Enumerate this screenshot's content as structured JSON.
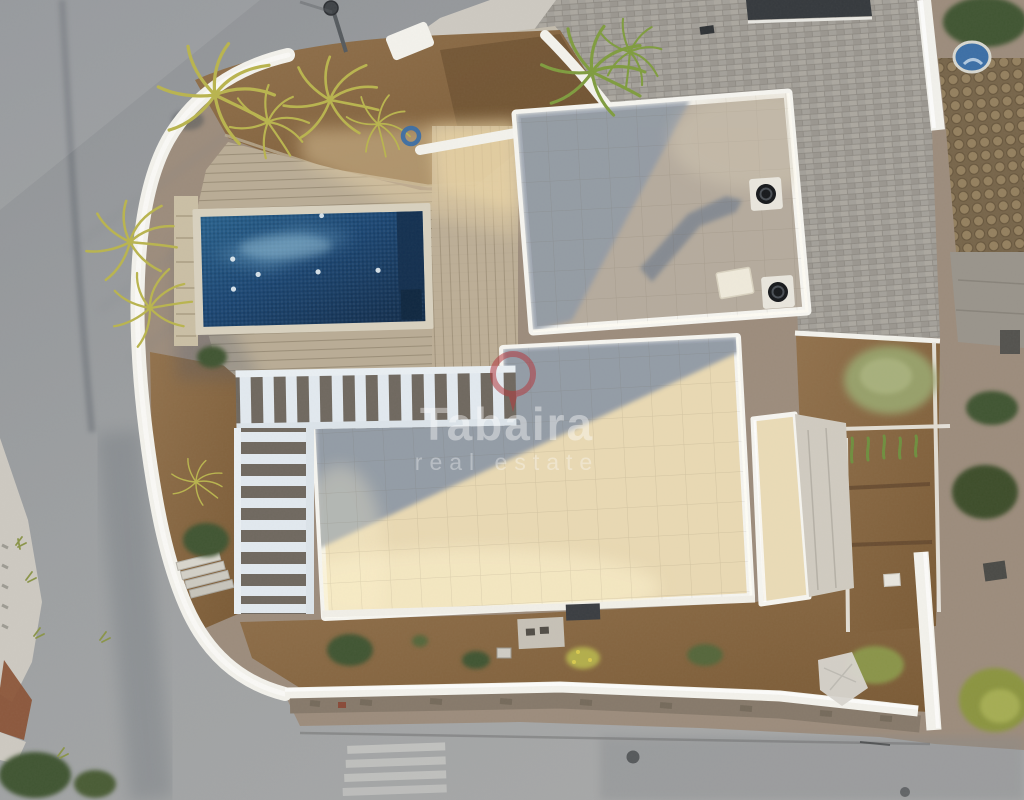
{
  "meta": {
    "image_type": "aerial drone photograph, top-down view",
    "subject": "modern white villa with swimming pool, curved perimeter wall, corner plot beside asphalt road"
  },
  "watermark": {
    "brand": "Tabaira",
    "tagline": "real estate",
    "logo": "map-pin-ring-icon",
    "text_color": "#ffffff",
    "logo_color": "#b23b3f"
  },
  "palette": {
    "road": "#9ea1a3",
    "road_dark": "#7e8286",
    "sidewalk": "#cdc9c1",
    "pavers": "#a3a099",
    "cobble": "#8d7a5e",
    "flagstone": "#99948b",
    "gravel": "#9c8c7c",
    "dirt": "#8a6845",
    "dirt_dark": "#6e5132",
    "deck": "#beb199",
    "deck_sun": "#e8d2a6",
    "stone_strip": "#cabfa5",
    "pool_deep": "#132f4e",
    "pool_main": "#1d4b77",
    "pool_light": "#6fa3c4",
    "coping": "#d8d1bf",
    "wall": "#f3f2ec",
    "stone_wall": "#86796a",
    "roof_field": "#b5ab9d",
    "roof_shadow": "#8f99a6",
    "roof_cream": "#e9d9b3",
    "roof_glow": "#fdf2cd",
    "terrace": "#d0cbc0",
    "parapet": "#f6f5f0",
    "pergola": "#e2e9ef",
    "wood": "#6f685f",
    "green_dark": "#415430",
    "green_sage": "#97a06a",
    "green_yellow": "#b3ae4b",
    "green_moss": "#8b9440",
    "rust": "#8a5134",
    "basin_blue": "#3c6fa6",
    "hose_blue": "#3b6ea5",
    "gate_dark": "#35393d",
    "marking_white": "#d9d9d4",
    "cloth_white": "#d8d5cf"
  },
  "scene": {
    "features": [
      "asphalt road with seam and tyre streaks",
      "street lamp",
      "curved white perimeter wall",
      "palm trees and ferns in planters",
      "rectangular swimming pool with mosaic tiles and lights",
      "wood-plank pool deck",
      "L-shaped pergola with white slats",
      "upper flat roof with two black vent fans",
      "main terrace roof half in shadow",
      "east wing roof and terrace",
      "grey paver driveway",
      "dark entrance gate",
      "brown cobblestone path",
      "blue water basin",
      "coiled garden hose",
      "gravel side yard with shrubs",
      "terraced garden beds with cacti",
      "stone retaining wall along street",
      "pedestrian crossing marks",
      "manhole cover",
      "white tarp in garden",
      "terracotta wall at sidewalk",
      "steps to garden"
    ]
  }
}
